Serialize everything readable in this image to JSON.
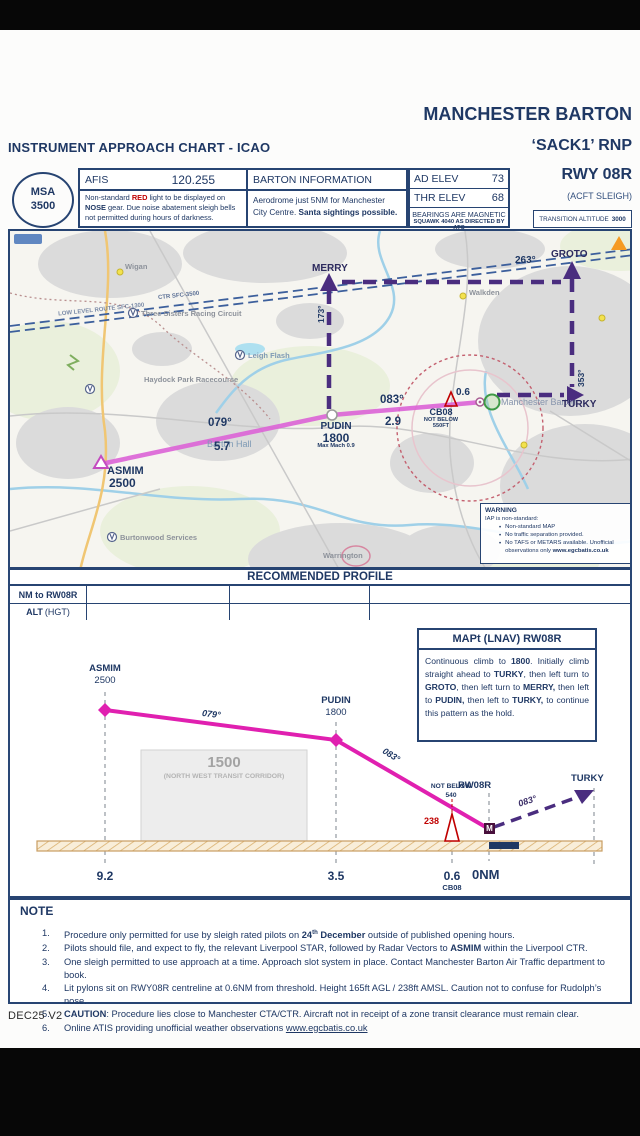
{
  "header": {
    "chart_type": "INSTRUMENT APPROACH CHART - ICAO",
    "airport": "MANCHESTER BARTON",
    "procedure": "‘SACK1’ RNP",
    "runway": "RWY 08R",
    "aircraft": "(ACFT SLEIGH)"
  },
  "info": {
    "msa_label": "MSA",
    "msa_value": "3500",
    "afis_label": "AFIS",
    "afis_freq": "120.255",
    "afis_note": [
      {
        "t": "Non-standard "
      },
      {
        "t": "RED",
        "b": true,
        "red": true
      },
      {
        "t": " light to be displayed on "
      },
      {
        "t": "NOSE",
        "b": true
      },
      {
        "t": " gear. Due noise abatement sleigh bells not permitted during hours of darkness."
      }
    ],
    "barton_header": "BARTON INFORMATION",
    "barton_note": [
      {
        "t": "Aerodrome just 5NM for Manchester City Centre. "
      },
      {
        "t": "Santa sightings possible.",
        "b": true
      }
    ],
    "ad_elev_label": "AD ELEV",
    "ad_elev_value": "73",
    "thr_elev_label": "THR ELEV",
    "thr_elev_value": "68",
    "bearings": "BEARINGS ARE MAGNETIC",
    "squawk": "SQUAWK 4040 AS DIRECTED BY ATC",
    "transition_label": "TRANSITION ALTITUDE",
    "transition_value": "3000"
  },
  "map": {
    "waypoints": {
      "asmim": {
        "name": "ASMIM",
        "alt": "2500"
      },
      "pudin": {
        "name": "PUDIN",
        "alt": "1800",
        "note": "Max Mach 0.9"
      },
      "cb08": {
        "name": "CB08",
        "restr1": "NOT BELOW",
        "restr2": "550FT",
        "dist": "0.6"
      },
      "merry": "MERRY",
      "groto": "GROTO",
      "turky": "TURKY"
    },
    "legs": {
      "leg1": {
        "track": "079°",
        "dist": "5.7"
      },
      "leg2": {
        "track": "083°",
        "dist": "2.9"
      }
    },
    "hold": {
      "south": "173°",
      "west": "263°",
      "north": "353°"
    },
    "towns": {
      "wigan": "Wigan",
      "walkden": "Walkden",
      "warrington": "Warrington",
      "leigh_flash": "Leigh Flash",
      "haydock": "Haydock Park Racecourse",
      "three_sisters": "Three Sisters Racing Circuit",
      "burtonwood": "Burtonwood Services",
      "barton_hall": "Barton Hall",
      "airport": "Manchester Barton"
    },
    "airspace": {
      "ctr": "CTR SFC-3500",
      "llr": "LOW LEVEL ROUTE SFC-1300"
    },
    "warning": {
      "title": "WARNING",
      "intro": "IAP is non-standard:",
      "bullets": [
        [
          {
            "t": "Non-standard MAP"
          }
        ],
        [
          {
            "t": "No traffic separation provided."
          }
        ],
        [
          {
            "t": "No TAFS or METARS available. Unofficial observations only "
          },
          {
            "t": "www.egcbatis.co.uk",
            "b": true
          }
        ]
      ]
    }
  },
  "profile_band": {
    "title": "RECOMMENDED PROFILE",
    "row1_label": "NM to RW08R",
    "row2_label_bold": "ALT",
    "row2_label_light": "(HGT)"
  },
  "mapt": {
    "title": "MAPt (LNAV) RW08R",
    "body": [
      {
        "t": "Continuous climb to "
      },
      {
        "t": "1800",
        "b": true
      },
      {
        "t": ". Initially climb straight ahead to "
      },
      {
        "t": "TURKY",
        "b": true
      },
      {
        "t": ", then left turn to "
      },
      {
        "t": "GROTO",
        "b": true
      },
      {
        "t": ", then left turn to "
      },
      {
        "t": "MERRY,",
        "b": true
      },
      {
        "t": " then left to "
      },
      {
        "t": "PUDIN,",
        "b": true
      },
      {
        "t": " then left to "
      },
      {
        "t": "TURKY,",
        "b": true
      },
      {
        "t": " to continue this pattern as the hold."
      }
    ]
  },
  "profile": {
    "asmim_name": "ASMIM",
    "asmim_alt": "2500",
    "pudin_name": "PUDIN",
    "pudin_alt": "1800",
    "track1": "079°",
    "track2": "083°",
    "missed_track": "083°",
    "corridor_alt": "1500",
    "corridor_name": "(NORTH WEST TRANSIT CORRIDOR)",
    "not_below1": "NOT BELOW",
    "not_below2": "540",
    "rwy": "RW08R",
    "turky": "TURKY",
    "obstacle": "238",
    "mapt_symbol": "M",
    "d1": "9.2",
    "d2": "3.5",
    "d3": "0.6",
    "d3_fix": "CB08",
    "d4": "0NM"
  },
  "notes": {
    "title": "NOTE",
    "items": [
      {
        "num": "1.",
        "segs": [
          {
            "t": "Procedure only permitted for use by sleigh rated pilots on "
          },
          {
            "t": "24",
            "b": true
          },
          {
            "t": "th",
            "b": true,
            "sup": true
          },
          {
            "t": " December",
            "b": true
          },
          {
            "t": " outside of published opening hours."
          }
        ]
      },
      {
        "num": "2.",
        "segs": [
          {
            "t": "Pilots should file, and expect to fly, the relevant Liverpool STAR, followed by Radar Vectors to "
          },
          {
            "t": "ASMIM",
            "b": true
          },
          {
            "t": " within the Liverpool CTR."
          }
        ]
      },
      {
        "num": "3.",
        "segs": [
          {
            "t": "One sleigh permitted to use approach at a time. Approach slot system in place. Contact Manchester Barton Air Traffic department to book."
          }
        ]
      },
      {
        "num": "4.",
        "segs": [
          {
            "t": "Lit pylons sit on RWY08R centreline at 0.6NM from threshold. Height 165ft AGL / 238ft AMSL. Caution not to confuse for Rudolph’s nose."
          }
        ]
      },
      {
        "num": "5.",
        "segs": [
          {
            "t": "CAUTION",
            "b": true
          },
          {
            "t": ": Procedure lies close to Manchester CTA/CTR. Aircraft not in receipt of a zone transit clearance must remain clear."
          }
        ]
      },
      {
        "num": "6.",
        "segs": [
          {
            "t": "Online ATIS providing unofficial weather observations "
          },
          {
            "t": "www.egcbatis.co.uk",
            "u": true,
            "link": true
          }
        ]
      }
    ]
  },
  "footer": "DEC25 V2"
}
